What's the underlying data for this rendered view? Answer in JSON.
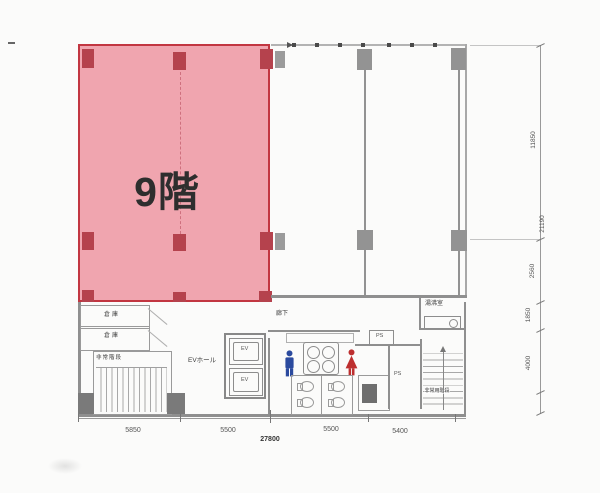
{
  "plan": {
    "floor_label": "9階",
    "core": {
      "storage_top": "倉庫",
      "storage_bottom": "倉庫",
      "left_stair": "非常階段",
      "ev_hall": "EVホール",
      "ev1": "EV",
      "ev2": "EV",
      "corridor": "廊下",
      "ps_top": "PS",
      "ps_mid": "PS",
      "kitchenette": "湯沸室",
      "right_stair": "非常用階段"
    },
    "dimensions": {
      "right": [
        "11850",
        "21190",
        "2560",
        "1850",
        "4000"
      ],
      "bottom": [
        "5850",
        "5500",
        "5500",
        "5400"
      ],
      "bottom_total": "27800"
    },
    "colors": {
      "highlight_fill": "#ec8492",
      "highlight_border": "#c23641",
      "column_red": "#b5424d",
      "wall_gray": "#8f8f8f",
      "men_icon": "#2b4a9e",
      "women_icon": "#bd2f2f"
    }
  }
}
